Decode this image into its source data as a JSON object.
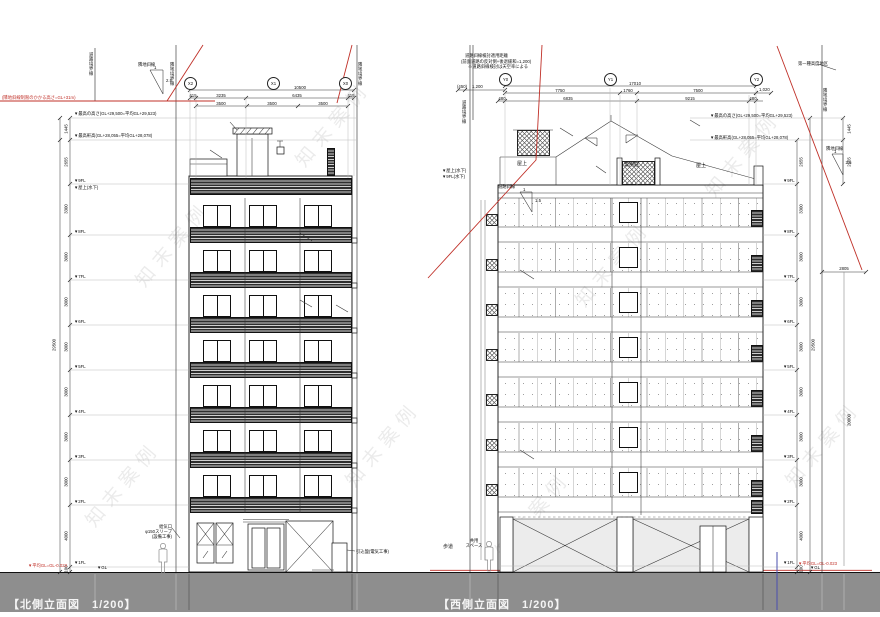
{
  "watermark": "知末案例",
  "titles": {
    "north": "【北側立面図　1/200】",
    "west": "【西側立面図　1/200】"
  },
  "common": {
    "level_max": "▼最高の高さ(GL+29,500=平均GL+29,523)",
    "level_eave": "▼最高軒高(GL+28,055=平均GL+28,078)",
    "avg_gl": "▼平均GL=GL-0.023",
    "floors": [
      "▼9FL",
      "▼8FL",
      "▼7FL",
      "▼6FL",
      "▼5FL",
      "▼4FL",
      "▼3FL",
      "▼2FL",
      "▼1FL",
      "▼GL"
    ],
    "rooftop_label": "▼屋上(水下)"
  },
  "north": {
    "grid": [
      "X2",
      "X1",
      "X0"
    ],
    "dim_overall": "10500",
    "dims_row2": [
      "415",
      "3235",
      "6435",
      "415"
    ],
    "dims_row3": [
      "3500",
      "3500",
      "3500"
    ],
    "dims_v": [
      "1445",
      "2655",
      "3300",
      "3000",
      "3000",
      "3000",
      "3000",
      "3000",
      "3000",
      "4000"
    ],
    "dim_base": "100",
    "dim_total": "29500",
    "slope": {
      "name": "隣地斜線",
      "run": "1",
      "rise": "2.5"
    },
    "red_note": "(隣地斜線制限のかかる高さ=GL+31m)",
    "boundaries": {
      "outer_left": "道路境界線",
      "left": "隣地境界線",
      "right": "隣地境界線"
    },
    "ann_vent": [
      "給気口",
      "φ150スリーブ",
      "(設備工事)"
    ],
    "ann_meter": "引込盤(電気工事)"
  },
  "west": {
    "grid": [
      "Y0",
      "Y1",
      "Y2"
    ],
    "dim_overall": "17010",
    "dims_row2": [
      "7750",
      "1760",
      "7500"
    ],
    "dims_row3": [
      "480",
      "6835",
      "9215",
      "480"
    ],
    "dim_left_a": "(450)",
    "dim_left_b": "1,200",
    "dim_right": "1,020",
    "dims_v": [
      "2655",
      "3300",
      "3000",
      "3000",
      "3000",
      "3000",
      "3000",
      "3000",
      "4000"
    ],
    "dim_base": "100",
    "dim_total": "29500",
    "dims_far_right": [
      "1445",
      "2655"
    ],
    "dim_setback": "2805",
    "dim_20m": "20000",
    "note_road": [
      "道路斜線検討適用距離",
      "(前面道路の反対側+後退緩和=1,200)",
      "※道路斜線検討は天空率による"
    ],
    "note_height_district": "第一種高度地区",
    "slope_road": {
      "name": "道路斜線",
      "run": "1",
      "rise": "1.5"
    },
    "slope_adj": {
      "name": "隣地斜線",
      "run": "1",
      "rise": "2.5"
    },
    "roof_labels": [
      "屋上",
      "専用庭",
      "屋上"
    ],
    "left_levels": [
      "▼屋上(水下)",
      "▼9FL(水下)"
    ],
    "ground_labels": {
      "sidewalk": "歩道",
      "common": [
        "共用",
        "スペース"
      ]
    },
    "boundaries": {
      "left": "道路境界線",
      "right": "隣地境界線"
    }
  }
}
